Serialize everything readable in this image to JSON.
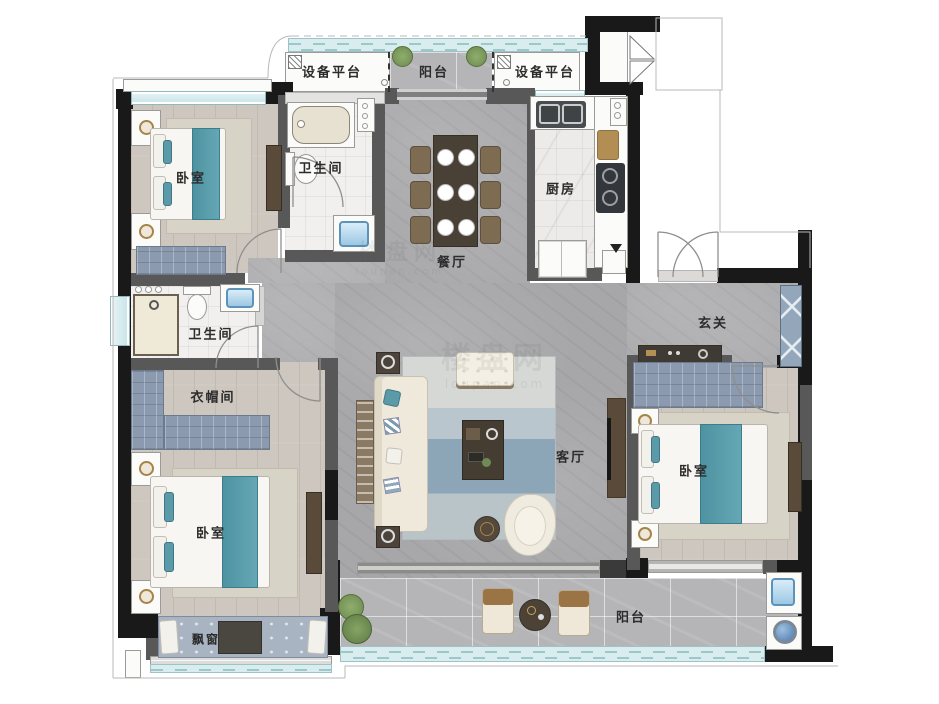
{
  "floorplan": {
    "rooms": [
      {
        "id": "equipment-platform-left",
        "label": "设备平台"
      },
      {
        "id": "balcony-top",
        "label": "阳台"
      },
      {
        "id": "equipment-platform-right",
        "label": "设备平台"
      },
      {
        "id": "bedroom-top-left",
        "label": "卧室"
      },
      {
        "id": "bathroom-top",
        "label": "卫生间"
      },
      {
        "id": "kitchen",
        "label": "厨房"
      },
      {
        "id": "dining-room",
        "label": "餐厅"
      },
      {
        "id": "foyer",
        "label": "玄关"
      },
      {
        "id": "bathroom-left",
        "label": "卫生间"
      },
      {
        "id": "cloakroom",
        "label": "衣帽间"
      },
      {
        "id": "living-room",
        "label": "客厅"
      },
      {
        "id": "bedroom-right",
        "label": "卧室"
      },
      {
        "id": "bedroom-bottom-left",
        "label": "卧室"
      },
      {
        "id": "bay-window",
        "label": "飘窗"
      },
      {
        "id": "balcony-bottom",
        "label": "阳台"
      }
    ],
    "watermark": {
      "cn": "楼盘网",
      "en": "loupan.com"
    },
    "colors": {
      "exterior_wall": "#191919",
      "interior_wall": "#585858",
      "window_glass": "#c6e4e8",
      "bed_teal": "#4e93a2",
      "cabinet_blue": "#8b9aae",
      "wood_floor": "#cdc7bf",
      "marble_floor": "#a7a7a9",
      "tile_floor": "#f1f0ee",
      "balcony_floor": "#b5b5b7"
    }
  }
}
